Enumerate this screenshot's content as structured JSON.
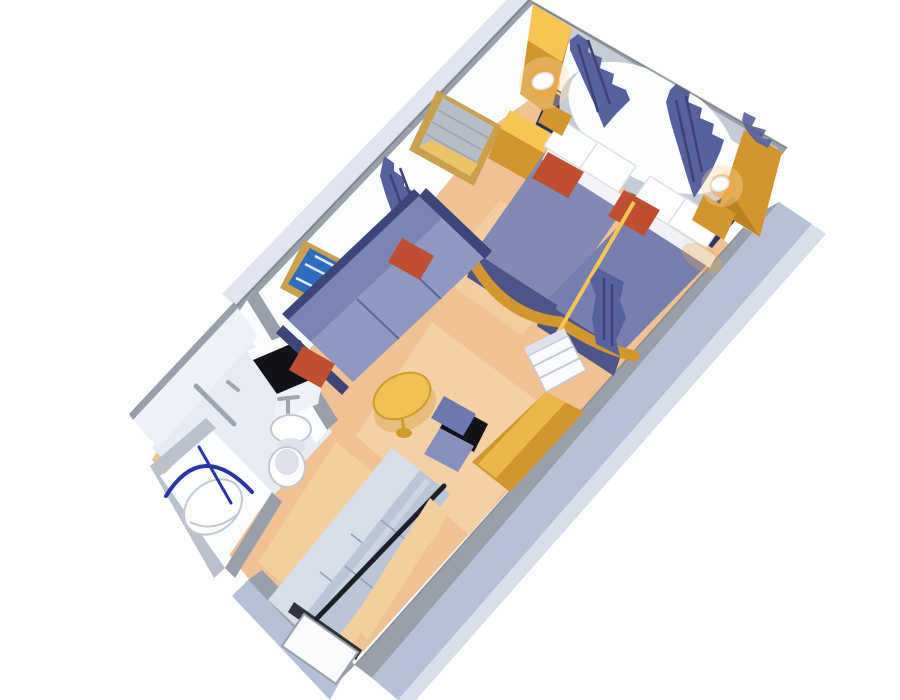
{
  "scene": {
    "title": "3D cutaway floor plan of a cruise ship stateroom",
    "type": "isometric-cutaway-render",
    "areas": [
      {
        "name": "sleeping-area",
        "items": [
          "twin-bed-left",
          "twin-bed-right",
          "round-window",
          "window-curtains",
          "gold-nightstand",
          "wall-sconce-left",
          "wall-sconce-right",
          "headboard-panel"
        ]
      },
      {
        "name": "living-area",
        "items": [
          "sofa",
          "orange-accent-pillows",
          "round-coffee-table",
          "wall-picture",
          "wall-mirror",
          "curtain-divider",
          "desk",
          "desk-chair",
          "white-cabinet"
        ]
      },
      {
        "name": "bathroom",
        "items": [
          "vanity-counter",
          "tv",
          "sink",
          "toilet",
          "towel-bar",
          "shower-stall",
          "shower-rod"
        ]
      },
      {
        "name": "entry",
        "items": [
          "closet-sliding-doors",
          "closet-rail",
          "corridor",
          "entry-door"
        ]
      }
    ]
  },
  "colors": {
    "bg": "#ffffff",
    "carpet": "#f0c192",
    "carpet_light": "#f8dcb4",
    "corridor_floor": "#f3cf9e",
    "bath_floor": "#e7ecf4",
    "bath_wall": "#eef2f8",
    "wall_white": "#fcfdfe",
    "wall_shade": "#e9edf4",
    "wall_edge": "#99a0ab",
    "wall_edge_light": "#bac1cd",
    "wall_edge_dark": "#5f6570",
    "outer_wall": "#b6c1d7",
    "outer_wall_light": "#d8dfeb",
    "navy": "#2d3463",
    "curtain": "#57619e",
    "curtain_dark": "#3b4277",
    "bedspread": "#8289b5",
    "bedspread_dark": "#767fae",
    "bed_side": "#4c5488",
    "pillow": "#ffffff",
    "pillow_shade": "#dde2ec",
    "accent_red": "#c04e30",
    "gold": "#d3962f",
    "gold_light": "#f6c554",
    "gold_dark": "#a97318",
    "sofa": "#7b85b4",
    "sofa_seat": "#8f98c3",
    "sofa_back": "#3e4579",
    "table": "#f1c152",
    "table_edge": "#cf9c2d",
    "frame_gold": "#c9a04e",
    "art_blue": "#2f6bc0",
    "art_mark": "#ffffff",
    "black": "#121318",
    "chair": "#6d78b0",
    "chair_seat": "#8690bd",
    "cabinet": "#fafbfd",
    "cabinet_line": "#c2c9d4",
    "closet_back": "#d7deea",
    "closet_glass": "#bac6d8",
    "closet_seam": "#8fa0b6",
    "rail": "#1e2029",
    "door": "#fbfcfd",
    "window": "#fdfefe",
    "window_shade": "#c6ccd6",
    "mirror_glass": "#b6bdc8",
    "glow": "#f2a43c",
    "glow_soft": "#fbd9a0",
    "fixture": "#9fa6b1",
    "shower_rod": "#2636a8"
  }
}
